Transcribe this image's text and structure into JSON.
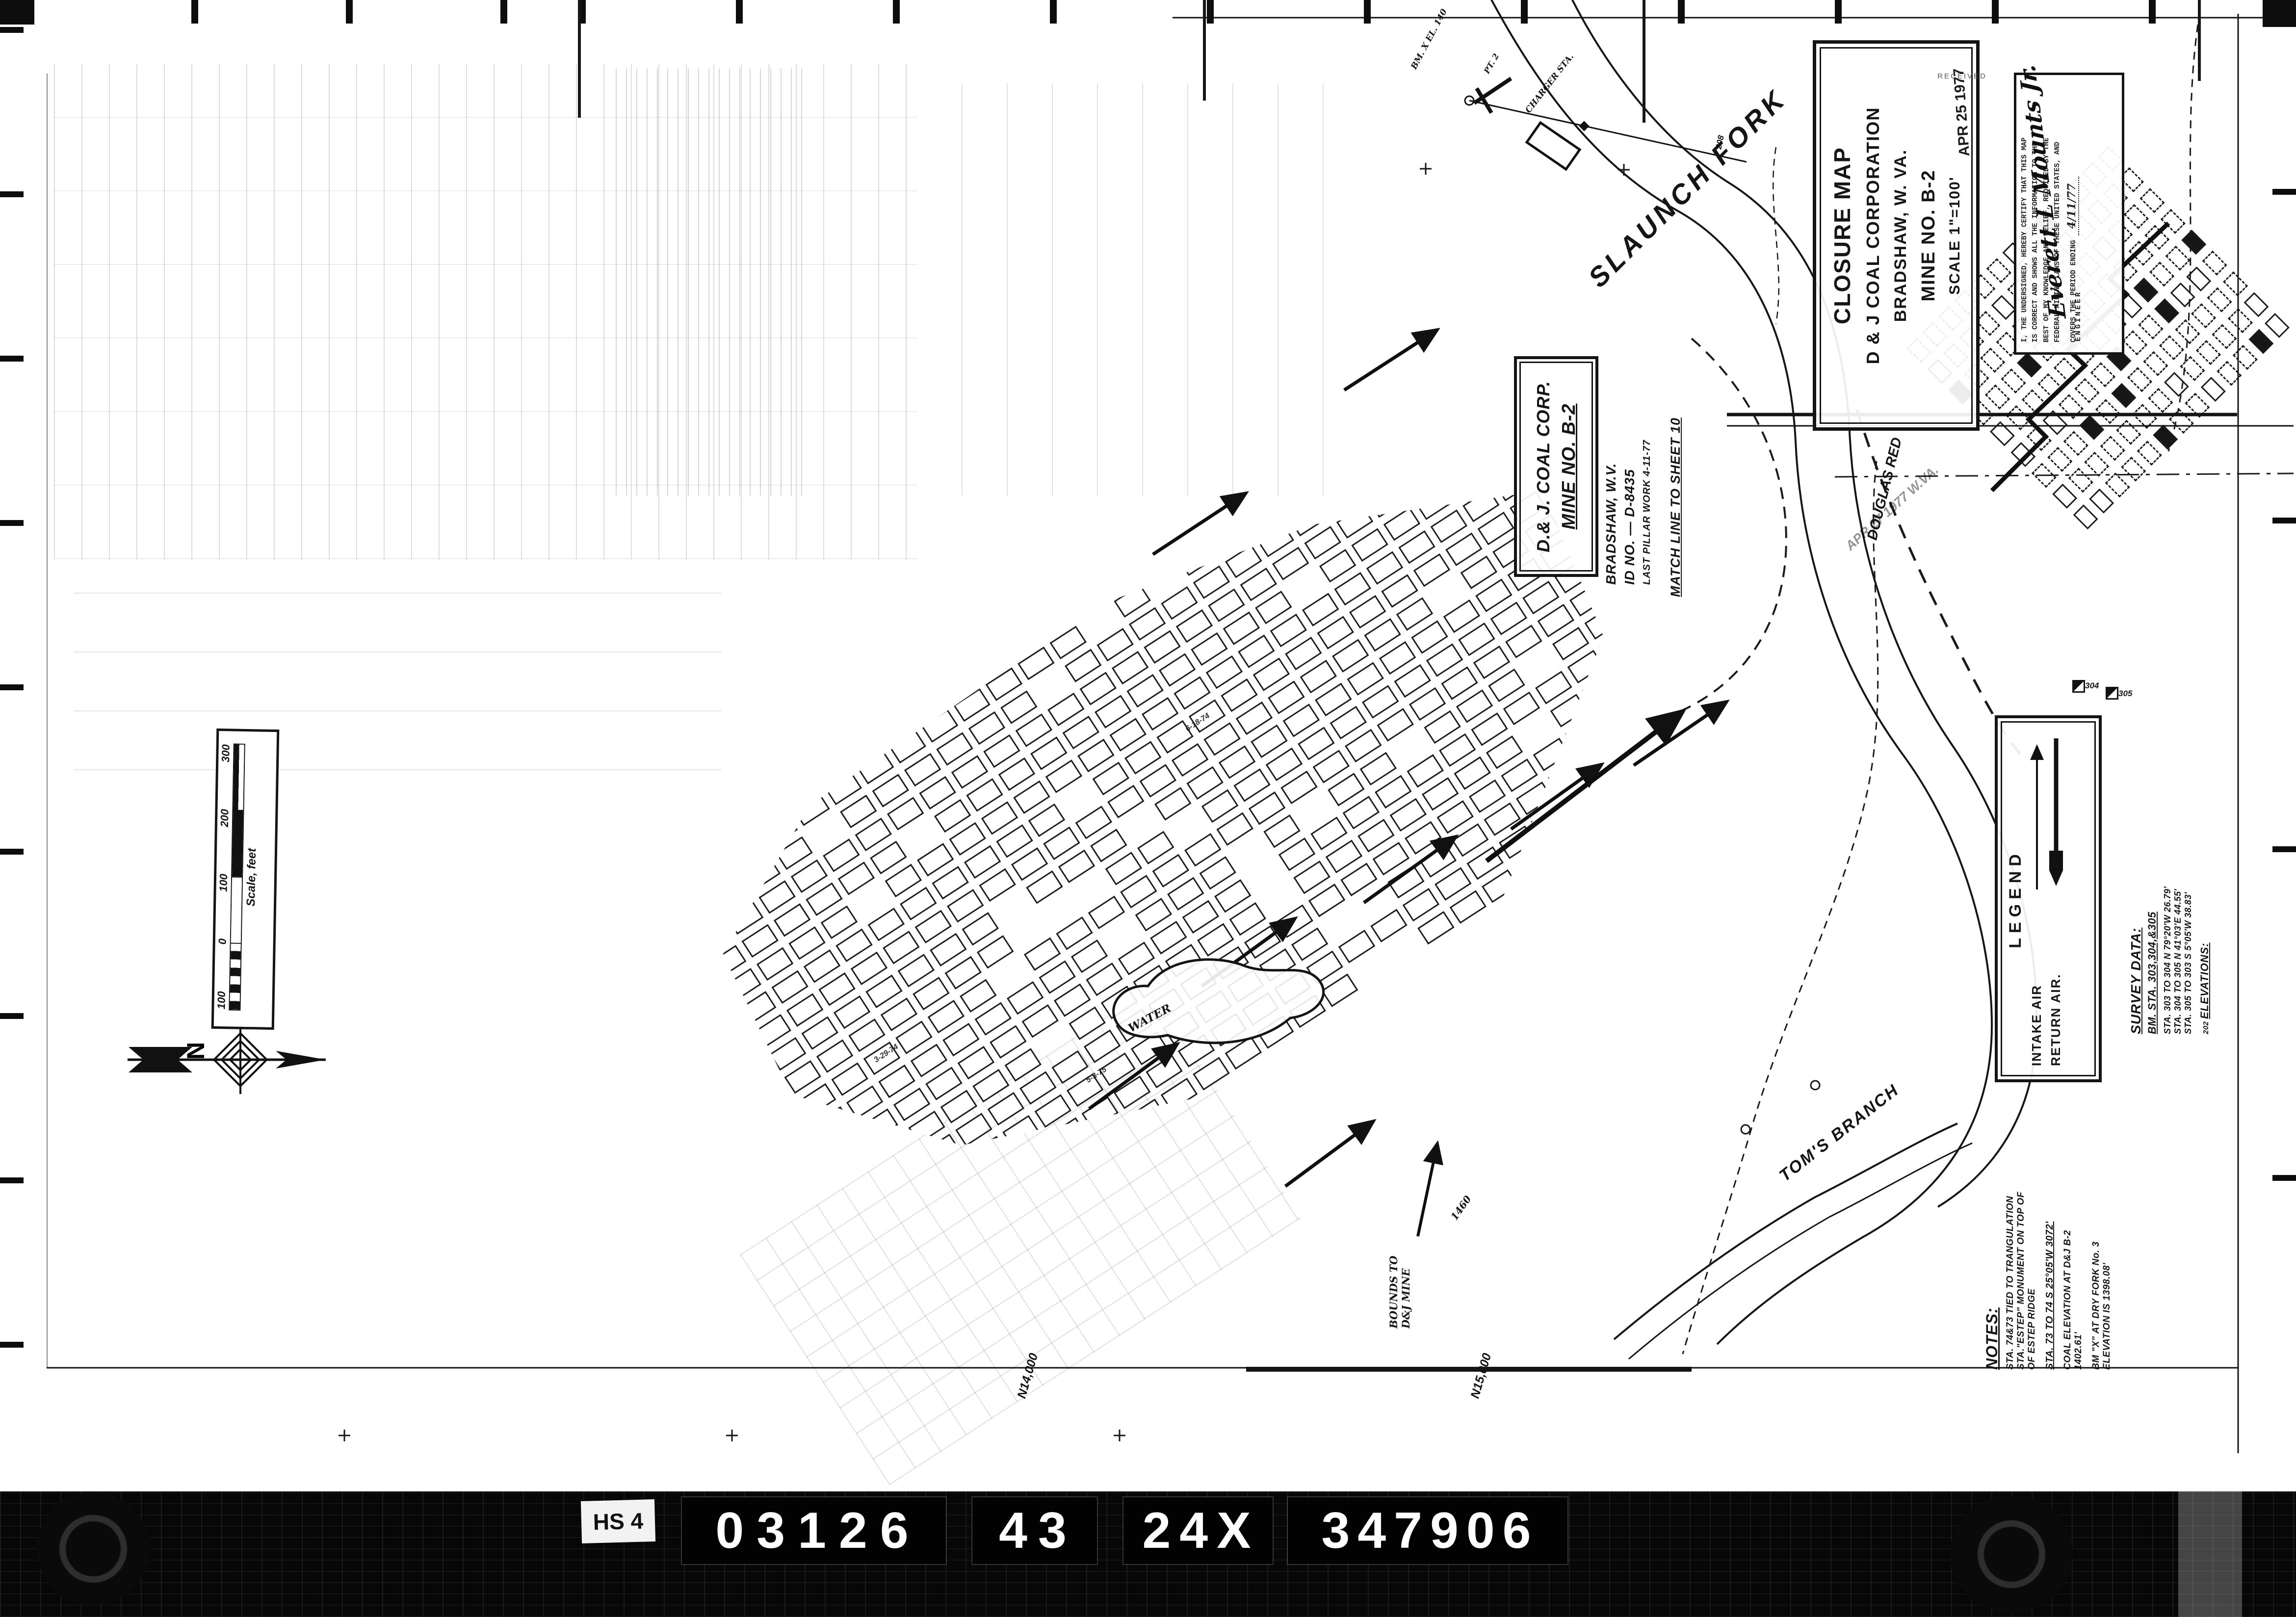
{
  "colors": {
    "ink": "#151515",
    "paper": "#ffffff",
    "film_band": "#070707",
    "faint_stamp": "#6b6b6b"
  },
  "title_block": {
    "line1": "CLOSURE MAP",
    "line2": "D & J COAL CORPORATION",
    "line3": "BRADSHAW, W. VA.",
    "line4": "MINE NO. B-2",
    "line5": "SCALE 1\"=100'",
    "stamp_date": "APR 25 1977",
    "stamp_received": "RECEIVED"
  },
  "stamp2": {
    "date": "APR 27 1977",
    "agency": "W.VA."
  },
  "cert": {
    "lines": [
      "I, THE UNDERSIGNED, HEREBY CERTIFY THAT THIS MAP",
      "IS CORRECT AND SHOWS ALL THE INFORMATION TO THE",
      "BEST OF MY KNOWLEDGE AND BELIEF, REQUIRED BY THE",
      "FEDERAL MINING LAWS OF THESE UNITED STATES, AND",
      "COVERS THE PERIOD ENDING"
    ],
    "period_ending": "4/11/77",
    "signature": "Everett L Mounts Jr.",
    "signer_title": "ENGINEER"
  },
  "mine_id": {
    "company": "D.& J. COAL CORP.",
    "mine": "MINE NO. B-2",
    "location": "BRADSHAW, W.V.",
    "id_no": "ID NO. — D-8435",
    "last_pillar_work": "LAST PILLAR WORK 4-11-77",
    "match_line": "MATCH LINE TO SHEET 10"
  },
  "legend": {
    "title": "LEGEND",
    "intake": "INTAKE AIR",
    "return": "RETURN AIR."
  },
  "survey": {
    "title": "SURVEY DATA:",
    "benchmarks": "BM. STA. 303,304,&305",
    "courses": [
      "STA. 303 TO 304  N 79°20'W   26.79'",
      "STA. 304 TO 305  N 41°03'E   44.55'",
      "STA. 305 TO 303  S 5°05'W    38.83'"
    ],
    "elev_mark": "202",
    "elevations": "ELEVATIONS:"
  },
  "notes": {
    "title": "NOTES:",
    "lines": [
      "STA. 74&73 TIED TO TRANGULATION",
      "STA.\"ESTEP\" MONUMENT ON TOP OF",
      "OF ESTEP RIDGE",
      "STA. 73 TO 74 S 25°05'W  3072'",
      "COAL ELEVATION AT D&J B-2",
      "1402.61'",
      "BM \"X\" AT DRY FORK No. 3",
      "ELEVATION IS 1398.08'"
    ]
  },
  "scale_bar": {
    "ticks": [
      "100",
      "0",
      "100",
      "200",
      "300"
    ],
    "label": "Scale, feet"
  },
  "north_label": "N",
  "labels": {
    "stream1": "SLAUNCH FORK",
    "stream2": "TOM'S BRANCH",
    "road": "DOUGLAS RED",
    "water": "WATER",
    "bounds1": "BOUNDS TO",
    "bounds2": "D&J MINE",
    "bm": "BM. X  EL. 140",
    "charger": "CHARGER STA.",
    "pt": "PT. 2",
    "contour1": "1460",
    "contour2": "208",
    "grid1": "N14,000",
    "grid2": "N15,000",
    "station1": "304",
    "station2": "305",
    "dates": [
      "3-29-74",
      "6-18-74",
      "5-3-75"
    ]
  },
  "footer": {
    "tag": "HS 4",
    "codes": [
      "03126",
      "43",
      "24X",
      "347906"
    ]
  }
}
